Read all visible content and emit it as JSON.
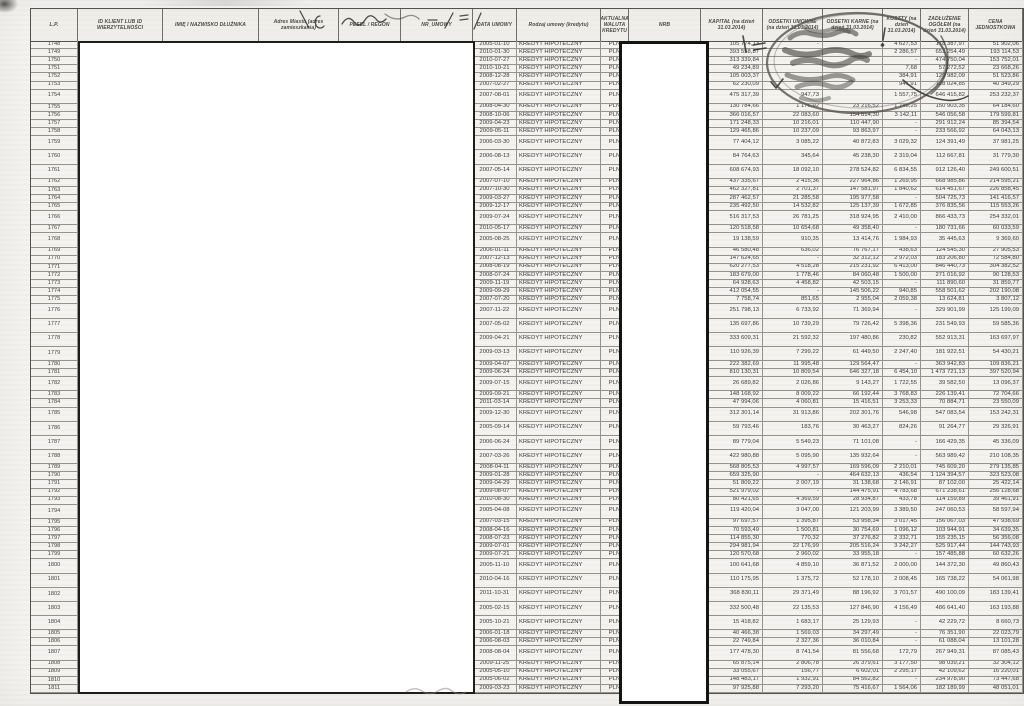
{
  "table": {
    "columns": [
      {
        "key": "lp",
        "label": "L.P."
      },
      {
        "key": "id_klient",
        "label": "ID KLIENT LUB ID WIERZYTELNOŚCI"
      },
      {
        "key": "imie_nazwisko",
        "label": "IMIĘ I NAZWISKO DŁUŻNIKA"
      },
      {
        "key": "adres",
        "label": "Adres Miasto (adres zamieszkania)"
      },
      {
        "key": "pesel_regon",
        "label": "PESEL / REGON"
      },
      {
        "key": "nr_umowy",
        "label": "NR_UMOWY"
      },
      {
        "key": "data_umowy",
        "label": "DATA UMOWY"
      },
      {
        "key": "rodzaj_umowy",
        "label": "Rodzaj umowy (kredytu)"
      },
      {
        "key": "waluta",
        "label": "AKTUALNA WALUTA KREDYTU"
      },
      {
        "key": "nrb",
        "label": "NRB"
      },
      {
        "key": "kapital",
        "label": "KAPITAŁ (na dzień 31.03.2014)"
      },
      {
        "key": "odsetki_umowne",
        "label": "ODSETKI UMOWNE (na dzień 31.03.2014)"
      },
      {
        "key": "odsetki_karne",
        "label": "ODSETKI KARNE (na dzień 31.03.2014)"
      },
      {
        "key": "koszty",
        "label": "KOSZTY (na dzień 31.03.2014)"
      },
      {
        "key": "zadluzenie_ogolem",
        "label": "ZADŁUŻENIE OGÓŁEM (na dzień 31.03.2014)"
      },
      {
        "key": "cena_jednostkowa",
        "label": "CENA JEDNOSTKOWA"
      }
    ],
    "row_fixed": {
      "loan_type": "KREDYT HIPOTECZNY",
      "currency": "PLN"
    },
    "rows_note": "fields: lp, data_umowy, kapital, odsetki_umowne, odsetki_karne, koszty, zadluzenie_ogolem, cena_jednostkowa, tall_row; empty strings = value hidden under ink stamp; redacted columns contain no visible data",
    "rows": [
      [
        "1748",
        "2005-01-10",
        "105 774,13",
        "-",
        "",
        "4 627,53",
        "178 387,97",
        "51 902,06",
        0
      ],
      [
        "1749",
        "2010-01-30",
        "393 558,87",
        "",
        "",
        "2 286,57",
        "653 254,49",
        "193 114,53",
        0
      ],
      [
        "1750",
        "2010-07-27",
        "313 339,84",
        "",
        "",
        "-",
        "474 750,04",
        "153 752,01",
        0
      ],
      [
        "1751",
        "2010-10-21",
        "49 234,89",
        "",
        "",
        "7,68",
        "57 272,52",
        "23 668,26",
        0
      ],
      [
        "1752",
        "2008-12-28",
        "105 003,37",
        "",
        "",
        "384,91",
        "129 982,09",
        "51 523,86",
        0
      ],
      [
        "1753",
        "2007-02-27",
        "62 230,09",
        "",
        "",
        "947,91",
        "128 024,85",
        "40 349,29",
        0
      ],
      [
        "1754",
        "2007-08-01",
        "475 317,39",
        "947,73",
        "",
        "1 557,75",
        "646 415,82",
        "253 232,37",
        1
      ],
      [
        "1755",
        "2008-04-30",
        "130 784,66",
        "1 176,92",
        "23 216,52",
        "1 745,25",
        "150 903,35",
        "64 184,60",
        0
      ],
      [
        "1756",
        "2008-10-06",
        "366 016,57",
        "22 083,60",
        "154 814,30",
        "3 142,11",
        "546 056,58",
        "179 599,81",
        0
      ],
      [
        "1757",
        "2009-04-23",
        "171 248,33",
        "10 216,01",
        "110 447,90",
        "-",
        "291 912,24",
        "85 394,54",
        0
      ],
      [
        "1758",
        "2009-05-11",
        "129 465,86",
        "10 237,09",
        "93 863,97",
        "-",
        "233 566,92",
        "64 043,13",
        0
      ],
      [
        "1759",
        "2006-03-30",
        "77 404,12",
        "3 085,22",
        "40 872,83",
        "3 029,32",
        "124 391,49",
        "37 981,25",
        1
      ],
      [
        "1760",
        "2006-08-13",
        "84 764,63",
        "345,64",
        "45 238,30",
        "2 319,04",
        "112 667,81",
        "31 779,30",
        1
      ],
      [
        "1761",
        "2007-05-14",
        "608 674,93",
        "18 092,10",
        "278 524,82",
        "6 834,55",
        "912 126,40",
        "249 600,51",
        1
      ],
      [
        "1762",
        "2007-07-10",
        "437 335,67",
        "2 415,36",
        "227 964,86",
        "1 269,95",
        "668 985,86",
        "214 595,21",
        0
      ],
      [
        "1763",
        "2007-10-30",
        "462 327,81",
        "2 701,37",
        "147 581,97",
        "1 840,62",
        "614 451,67",
        "226 858,45",
        0
      ],
      [
        "1764",
        "2009-03-27",
        "287 462,57",
        "21 285,58",
        "195 977,58",
        "-",
        "504 725,73",
        "141 416,57",
        0
      ],
      [
        "1765",
        "2009-12-17",
        "235 492,50",
        "14 532,82",
        "125 137,39",
        "1 672,85",
        "376 835,56",
        "115 553,26",
        0
      ],
      [
        "1766",
        "2009-07-24",
        "516 317,53",
        "26 781,25",
        "318 924,95",
        "2 410,00",
        "866 433,73",
        "254 332,01",
        1
      ],
      [
        "1767",
        "2010-05-17",
        "120 518,58",
        "10 654,68",
        "49 358,40",
        "-",
        "180 731,66",
        "60 033,59",
        0
      ],
      [
        "1768",
        "2005-08-25",
        "19 138,59",
        "910,35",
        "13 414,76",
        "1 984,93",
        "35 445,63",
        "9 369,60",
        1
      ],
      [
        "1769",
        "2006-01-11",
        "46 580,48",
        "636,02",
        "76 767,17",
        "438,63",
        "124 545,30",
        "27 905,53",
        0
      ],
      [
        "1770",
        "2007-12-13",
        "147 624,65",
        "-",
        "32 312,12",
        "2 972,03",
        "183 206,80",
        "72 584,80",
        0
      ],
      [
        "1771",
        "2008-08-19",
        "620 277,53",
        "4 518,28",
        "215 231,92",
        "6 413,00",
        "846 440,73",
        "304 382,52",
        0
      ],
      [
        "1772",
        "2008-07-24",
        "183 679,00",
        "1 778,46",
        "84 060,48",
        "1 500,00",
        "271 016,92",
        "90 128,53",
        0
      ],
      [
        "1773",
        "2009-11-19",
        "64 928,63",
        "4 458,82",
        "42 503,15",
        "-",
        "111 890,60",
        "31 859,77",
        0
      ],
      [
        "1774",
        "2009-09-29",
        "412 054,55",
        "-",
        "145 506,22",
        "940,85",
        "558 501,62",
        "202 190,08",
        0
      ],
      [
        "1775",
        "2007-07-20",
        "7 758,74",
        "851,65",
        "2 955,04",
        "2 059,38",
        "13 624,81",
        "3 807,12",
        0
      ],
      [
        "1776",
        "2007-11-22",
        "251 798,13",
        "6 733,92",
        "71 369,94",
        "-",
        "329 901,99",
        "125 199,09",
        1
      ],
      [
        "1777",
        "2007-05-02",
        "135 697,86",
        "10 739,29",
        "79 726,42",
        "5 398,36",
        "231 549,93",
        "59 585,36",
        1
      ],
      [
        "1778",
        "2009-04-21",
        "333 609,31",
        "21 592,32",
        "197 480,86",
        "230,82",
        "552 913,31",
        "163 697,97",
        1
      ],
      [
        "1779",
        "2009-03-13",
        "110 926,39",
        "7 299,22",
        "61 449,50",
        "2 247,40",
        "181 922,51",
        "54 430,21",
        1
      ],
      [
        "1780",
        "2009-04-07",
        "222 382,69",
        "11 995,48",
        "129 564,47",
        "-",
        "363 942,83",
        "109 836,21",
        0
      ],
      [
        "1781",
        "2009-06-24",
        "810 130,31",
        "10 809,54",
        "646 327,18",
        "6 454,10",
        "1 473 721,13",
        "397 520,94",
        0
      ],
      [
        "1782",
        "2009-07-15",
        "26 689,82",
        "2 026,86",
        "9 143,27",
        "1 722,55",
        "39 582,50",
        "13 096,37",
        1
      ],
      [
        "1783",
        "2009-09-21",
        "148 168,92",
        "8 009,22",
        "66 192,44",
        "3 768,83",
        "226 139,41",
        "72 704,66",
        0
      ],
      [
        "1784",
        "2011-03-14",
        "47 994,06",
        "4 060,81",
        "15 416,51",
        "3 253,33",
        "70 884,71",
        "23 550,09",
        0
      ],
      [
        "1785",
        "2009-12-30",
        "312 301,14",
        "31 913,86",
        "202 301,76",
        "546,98",
        "547 083,54",
        "153 242,31",
        1
      ],
      [
        "1786",
        "2005-09-14",
        "59 793,46",
        "183,76",
        "30 463,27",
        "824,26",
        "91 264,77",
        "29 326,91",
        1
      ],
      [
        "1787",
        "2006-06-24",
        "89 779,04",
        "5 549,23",
        "71 101,08",
        "-",
        "166 429,35",
        "45 336,09",
        1
      ],
      [
        "1788",
        "2007-03-26",
        "422 980,88",
        "5 095,90",
        "135 932,64",
        "-",
        "563 989,42",
        "210 108,35",
        1
      ],
      [
        "1789",
        "2008-04-11",
        "568 805,53",
        "4 997,57",
        "169 596,09",
        "2 210,01",
        "745 609,20",
        "279 135,85",
        0
      ],
      [
        "1790",
        "2009-01-28",
        "659 325,90",
        "-",
        "464 632,13",
        "436,54",
        "1 124 394,57",
        "323 523,08",
        0
      ],
      [
        "1791",
        "2009-04-29",
        "51 809,22",
        "2 007,19",
        "31 138,68",
        "2 146,91",
        "87 102,00",
        "25 422,14",
        0
      ],
      [
        "1792",
        "2009-08-07",
        "521 979,02",
        "-",
        "144 475,91",
        "4 783,68",
        "671 238,61",
        "256 128,68",
        0
      ],
      [
        "1793",
        "2010-08-30",
        "80 421,65",
        "4 369,59",
        "28 934,87",
        "433,78",
        "114 159,89",
        "39 461,91",
        0
      ],
      [
        "1794",
        "2005-04-08",
        "119 420,04",
        "3 047,00",
        "121 203,99",
        "3 389,50",
        "247 060,53",
        "58 597,94",
        1
      ],
      [
        "1795",
        "2007-03-15",
        "97 697,57",
        "1 395,87",
        "53 958,34",
        "3 017,45",
        "156 067,03",
        "47 938,69",
        0
      ],
      [
        "1796",
        "2008-04-16",
        "70 593,49",
        "1 500,81",
        "30 754,69",
        "1 096,12",
        "103 944,91",
        "34 639,35",
        0
      ],
      [
        "1797",
        "2008-07-23",
        "114 855,30",
        "770,32",
        "37 276,82",
        "2 332,71",
        "155 235,15",
        "56 356,08",
        0
      ],
      [
        "1798",
        "2009-07-01",
        "294 981,94",
        "22 176,99",
        "205 516,24",
        "3 242,27",
        "525 917,44",
        "144 743,93",
        0
      ],
      [
        "1799",
        "2009-07-21",
        "120 570,68",
        "2 960,02",
        "33 955,18",
        "-",
        "157 485,88",
        "60 632,26",
        0
      ],
      [
        "1800",
        "2005-11-10",
        "100 641,68",
        "4 859,10",
        "36 871,52",
        "2 000,00",
        "144 372,30",
        "49 860,43",
        1
      ],
      [
        "1801",
        "2010-04-16",
        "110 175,95",
        "1 375,72",
        "52 178,10",
        "2 008,45",
        "165 738,22",
        "54 061,98",
        1
      ],
      [
        "1802",
        "2011-10-31",
        "368 830,11",
        "29 371,49",
        "88 196,92",
        "3 701,57",
        "490 100,09",
        "183 139,41",
        1
      ],
      [
        "1803",
        "2005-02-15",
        "332 500,48",
        "22 135,53",
        "127 846,90",
        "4 156,49",
        "486 641,40",
        "163 193,88",
        1
      ],
      [
        "1804",
        "2005-10-21",
        "15 418,82",
        "1 683,17",
        "25 129,93",
        "-",
        "42 229,72",
        "8 660,73",
        1
      ],
      [
        "1805",
        "2006-01-18",
        "40 466,38",
        "1 569,03",
        "34 297,49",
        "-",
        "76 351,90",
        "22 023,79",
        0
      ],
      [
        "1806",
        "2006-08-03",
        "22 749,84",
        "2 327,36",
        "36 010,84",
        "-",
        "61 088,04",
        "13 101,28",
        0
      ],
      [
        "1807",
        "2008-08-04",
        "177 478,30",
        "8 741,54",
        "81 556,68",
        "172,79",
        "267 949,31",
        "87 085,43",
        1
      ],
      [
        "1808",
        "2009-11-25",
        "65 875,14",
        "2 806,78",
        "26 379,61",
        "3 177,50",
        "98 039,21",
        "32 304,12",
        0
      ],
      [
        "1809",
        "2005-05-10",
        "33 055,67",
        "156,77",
        "6 602,01",
        "2 295,17",
        "42 109,62",
        "16 220,01",
        0
      ],
      [
        "1810",
        "2005-06-02",
        "148 483,17",
        "1 932,91",
        "84 562,82",
        "-",
        "234 978,90",
        "73 447,68",
        0
      ],
      [
        "1811",
        "2009-03-23",
        "97 925,88",
        "7 293,20",
        "75 416,67",
        "1 564,06",
        "182 189,99",
        "48 051,01",
        0
      ]
    ]
  },
  "annotations": {
    "redaction_left": "white redaction box over debtor identity columns",
    "redaction_nrb": "white redaction box over NRB column",
    "stamp": "round-ink-stamp-illegible",
    "handwriting_header": "pen-scribbles over address header",
    "handwriting_bottom": "faint pen scribble at bottom edge"
  },
  "colors": {
    "paper": "#f4f3f0",
    "ink": "#3b3b3b",
    "stamp_ink": "#4b4945",
    "grid_line": "#96938c"
  }
}
